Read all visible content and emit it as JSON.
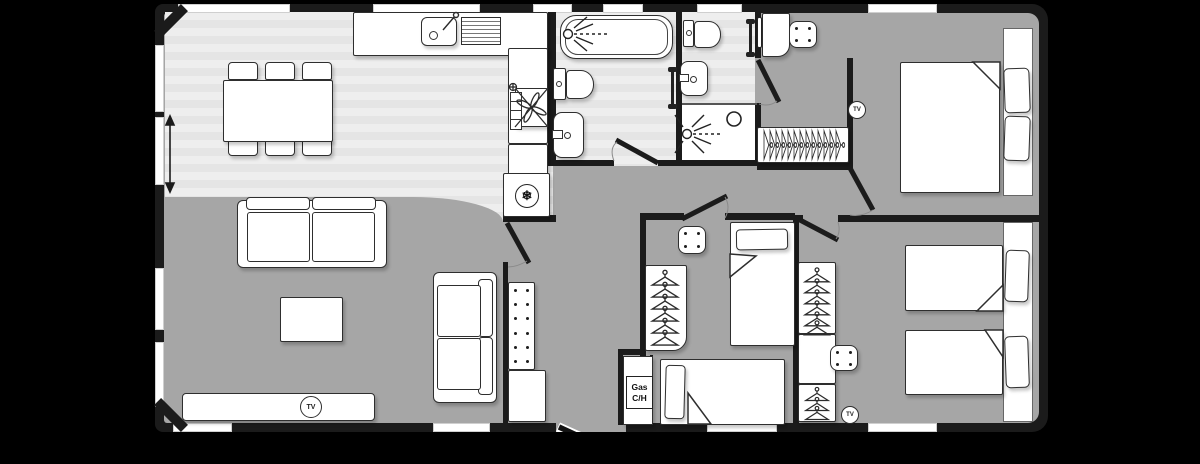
{
  "labels": {
    "tv": "TV",
    "gas_line1": "Gas",
    "gas_line2": "C/H"
  },
  "icons": {
    "snowflake": "❄",
    "shower": "shower-spray",
    "hanger": "clothes-hanger",
    "double-arrow": "vertical-measure-arrow"
  },
  "colors": {
    "background": "#000000",
    "wall": "#1b1b1b",
    "carpet": "#a6a6a6",
    "wood_floor": "#ebebeb",
    "furniture": "#ffffff",
    "outline": "#2e2e2e"
  }
}
